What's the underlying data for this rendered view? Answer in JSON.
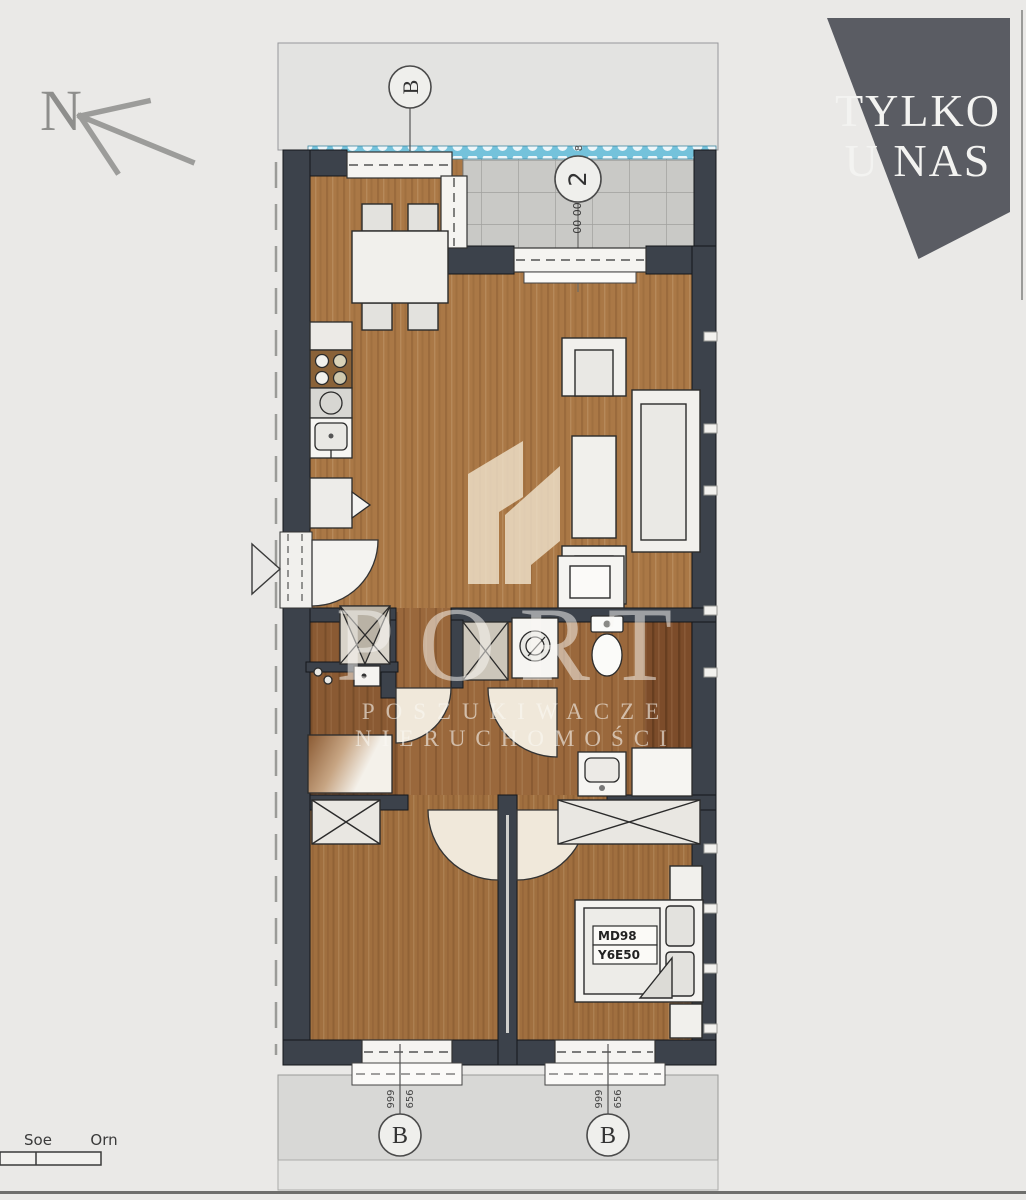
{
  "compass": {
    "label": "N"
  },
  "badge": {
    "line1": "TYLKO",
    "line2": "U NAS",
    "bg": "#5a5c63",
    "text_color": "#f3f3f1"
  },
  "watermark": {
    "brand": "PORT",
    "tagline1": "POSZUKIWACZE",
    "tagline2": "NIERUCHOMOŚCI"
  },
  "plan": {
    "section_top": "B",
    "section_bottom_left": "B",
    "section_bottom_right": "B",
    "balcony": {
      "circle": "2",
      "tiny_top": "8",
      "tiny_bottom": "00 00",
      "dim_top": "0,00",
      "dim_bottom": "x 2"
    },
    "bed_label": {
      "line1": "MD98",
      "line2": "Y6E50"
    },
    "dims": {
      "bl_a": "999",
      "bl_b": "656",
      "br_a": "999",
      "br_b": "656"
    },
    "colors": {
      "wall": "#3c424b",
      "wood_living": "#aa7846",
      "wood_bedroom": "#a06f3f",
      "wood_dark": "#7c4c2a",
      "wood_wardrobe": "#8a5a33",
      "balcony_tile": "#c9c9c6",
      "railing_blue": "#74c2db",
      "furniture": "#f1f0ec",
      "background": "#eae9e7"
    }
  },
  "scalebar": {
    "label_left": "Soe",
    "label_right": "Orn"
  }
}
